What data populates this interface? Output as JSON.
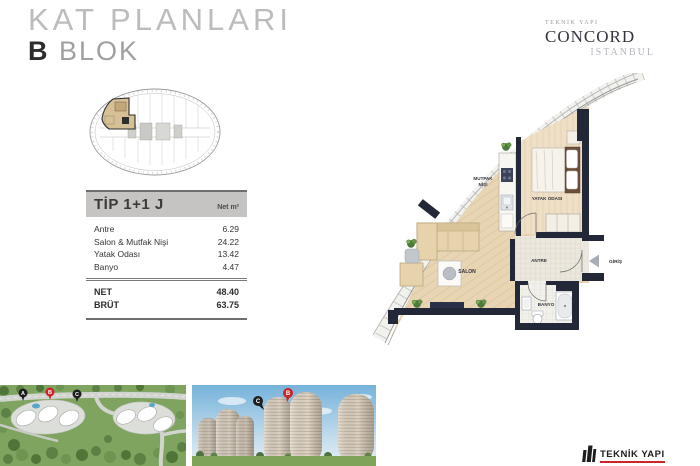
{
  "header": {
    "title": "KAT PLANLARI",
    "block_letter": "B",
    "block_word": "BLOK"
  },
  "brand": {
    "company": "TEKNİK YAPI",
    "project": "CONCORD",
    "city": "ISTANBUL"
  },
  "spec_table": {
    "title": "TİP 1+1 J",
    "unit_header": "Net m²",
    "rows": [
      {
        "label": "Antre",
        "value": "6.29"
      },
      {
        "label": "Salon & Mutfak Nişi",
        "value": "24.22"
      },
      {
        "label": "Yatak Odası",
        "value": "13.42"
      },
      {
        "label": "Banyo",
        "value": "4.47"
      }
    ],
    "totals": [
      {
        "label": "NET",
        "value": "48.40"
      },
      {
        "label": "BRÜT",
        "value": "63.75"
      }
    ]
  },
  "floor_plan": {
    "labels": {
      "mutfak_line1": "MUTFAK",
      "mutfak_line2": "NİŞİ",
      "yatak": "YATAK ODASI",
      "salon": "SALON",
      "antre": "ANTRE",
      "banyo": "BANYO",
      "giris": "GİRİŞ"
    }
  },
  "site_map": {
    "markers": [
      {
        "label": "A",
        "color": "#1d1d1d"
      },
      {
        "label": "B",
        "color": "#c9252b"
      },
      {
        "label": "C",
        "color": "#1d1d1d"
      }
    ]
  },
  "towers_view": {
    "markers": [
      {
        "label": "C",
        "color": "#1d1d1d"
      },
      {
        "label": "B",
        "color": "#c9252b"
      }
    ]
  },
  "footer": {
    "logo_text": "TEKNİK YAPI"
  },
  "colors": {
    "accent_red": "#c9252b",
    "wall": "#222838",
    "wood": "#e8d5b4",
    "bedroom_wood": "#eedfc6",
    "table_header_bg": "#c6c4c2"
  }
}
